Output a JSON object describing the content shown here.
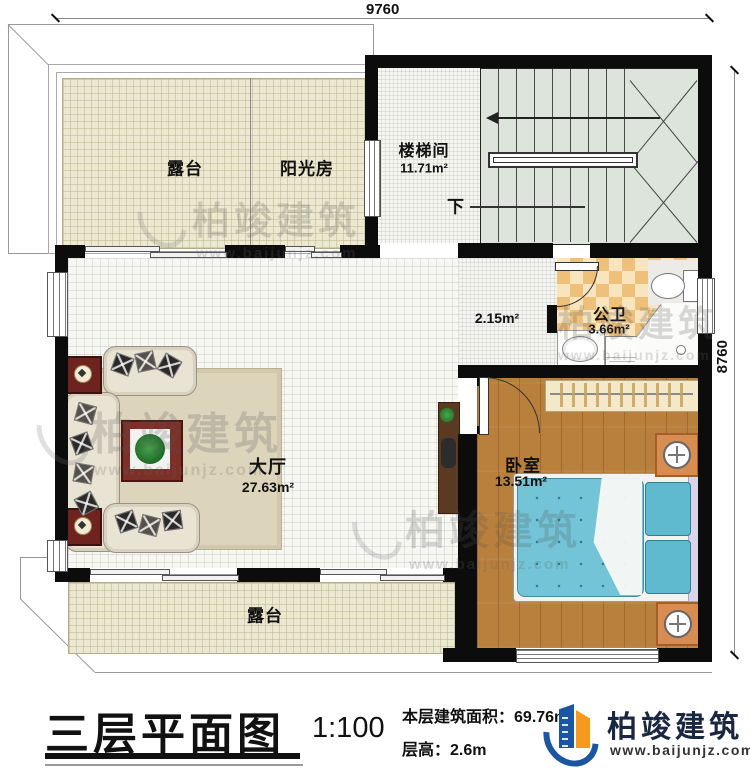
{
  "dimensions": {
    "top": "9760",
    "right": "8760"
  },
  "rooms": {
    "terrace_top": {
      "label": "露台"
    },
    "sunroom": {
      "label": "阳光房"
    },
    "stairwell": {
      "label": "楼梯间",
      "area": "11.71m²"
    },
    "corridor": {
      "area": "2.15m²"
    },
    "bathroom": {
      "label": "公卫",
      "area": "3.66m²"
    },
    "hall": {
      "label": "大厅",
      "area": "27.63m²"
    },
    "bedroom": {
      "label": "卧室",
      "area": "13.51m²"
    },
    "terrace_bottom": {
      "label": "露台"
    }
  },
  "stairs": {
    "down_label": "下"
  },
  "title_block": {
    "title": "三层平面图",
    "scale": "1:100",
    "area_label": "本层建筑面积：",
    "area_value": "69.76m²",
    "floor_height_label": "层高：",
    "floor_height_value": "2.6m"
  },
  "brand": {
    "name": "柏竣建筑",
    "website": "www.baijunjz.com"
  },
  "watermark": {
    "name": "柏竣建筑",
    "website": "www.baijunjz.com"
  },
  "colors": {
    "wall": "#0c0c0c",
    "terrace_floor": "#ece8d1",
    "stair_floor": "#dde4db",
    "bathroom_tile_a": "#eec07a",
    "bathroom_tile_b": "#f8e4bd",
    "bedroom_floor": "#b97f3c",
    "bed_blue": "#72c4d6",
    "brand_blue": "#1c56a0",
    "brand_orange": "#f59a1e"
  }
}
